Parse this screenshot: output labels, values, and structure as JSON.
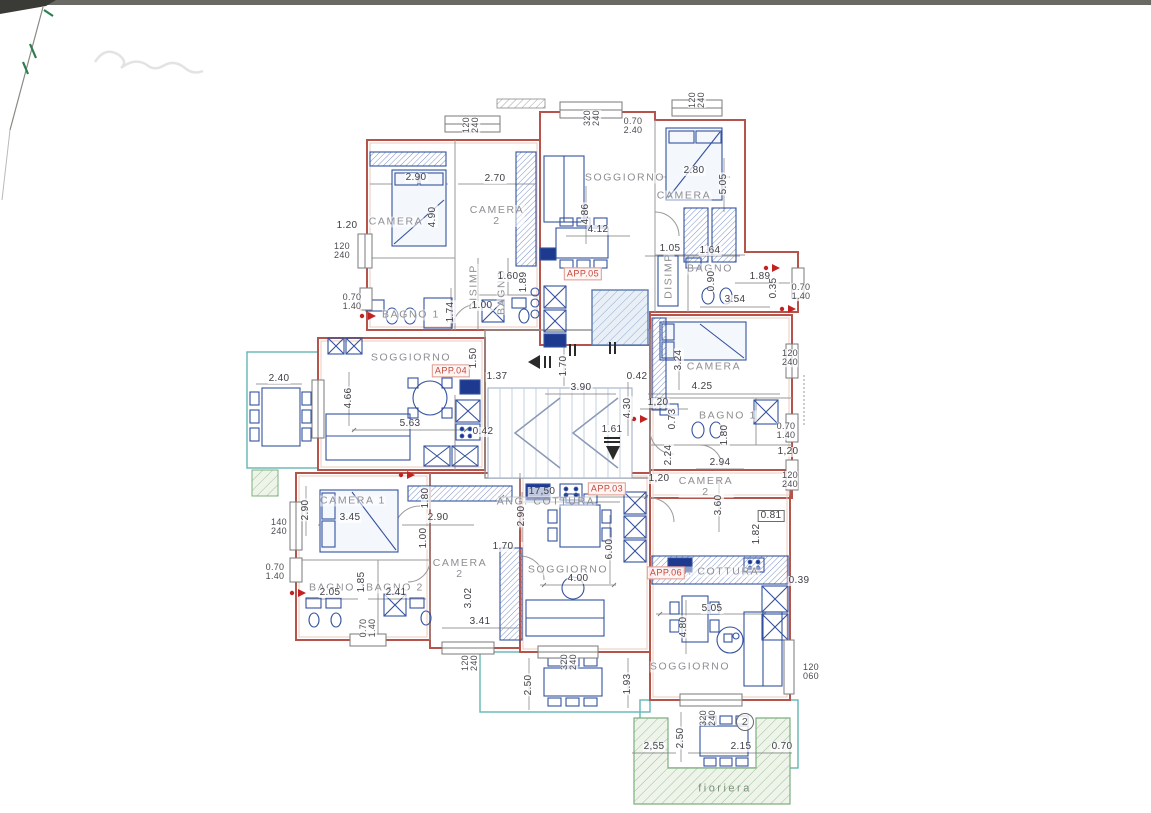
{
  "palette": {
    "wall_red": "#b5544b",
    "wall_pink": "#ecc8bf",
    "partition_gray": "#9a9a9a",
    "furniture_blue": "#33519e",
    "appliance_navy": "#1d3a8f",
    "terrace_teal": "#62b7b4",
    "planter_green": "#7fae7f",
    "elevator_blue": "#8fa9cd",
    "tag_red": "#c3463d",
    "dim_text": "#3e3e45",
    "room_text": "#8e8e93",
    "scan_mark_green": "#2e7d4f"
  },
  "plan": {
    "rooms": [
      {
        "t": "CAMERA",
        "x": 396,
        "y": 222
      },
      {
        "t": "CAMERA\n2",
        "x": 497,
        "y": 216
      },
      {
        "t": "SOGGIORNO",
        "x": 625,
        "y": 178
      },
      {
        "t": "CAMERA",
        "x": 684,
        "y": 196
      },
      {
        "t": "BAGNO",
        "x": 710,
        "y": 269
      },
      {
        "t": "DISIMP",
        "x": 474,
        "y": 287,
        "r": 1
      },
      {
        "t": "BAGNO",
        "x": 502,
        "y": 292,
        "r": 1
      },
      {
        "t": "DISIMP",
        "x": 669,
        "y": 276,
        "r": 1
      },
      {
        "t": "BAGNO 1",
        "x": 411,
        "y": 315
      },
      {
        "t": "SOGGIORNO",
        "x": 411,
        "y": 358
      },
      {
        "t": "CAMERA",
        "x": 714,
        "y": 367
      },
      {
        "t": "BAGNO 1",
        "x": 728,
        "y": 416
      },
      {
        "t": "CAMERA\n2",
        "x": 706,
        "y": 487
      },
      {
        "t": "CAMERA 1",
        "x": 353,
        "y": 501
      },
      {
        "t": "CAMERA\n2",
        "x": 460,
        "y": 569
      },
      {
        "t": "BAGNO 1",
        "x": 338,
        "y": 588
      },
      {
        "t": "BAGNO 2",
        "x": 395,
        "y": 588
      },
      {
        "t": "ANG. COTTURA",
        "x": 546,
        "y": 502
      },
      {
        "t": "SOGGIORNO",
        "x": 568,
        "y": 570
      },
      {
        "t": "ANG. COTTURA",
        "x": 710,
        "y": 572
      },
      {
        "t": "SOGGIORNO",
        "x": 690,
        "y": 667
      }
    ],
    "tags": [
      {
        "t": "APP.05",
        "x": 583,
        "y": 274
      },
      {
        "t": "APP.04",
        "x": 451,
        "y": 371
      },
      {
        "t": "APP.03",
        "x": 607,
        "y": 489
      },
      {
        "t": "APP.06",
        "x": 666,
        "y": 573
      }
    ],
    "windows": [
      {
        "t": "120\n240",
        "x": 471,
        "y": 125,
        "r": 1
      },
      {
        "t": "320\n240",
        "x": 592,
        "y": 118,
        "r": 1
      },
      {
        "t": "0.70\n2.40",
        "x": 633,
        "y": 126
      },
      {
        "t": "120\n240",
        "x": 697,
        "y": 100,
        "r": 1
      },
      {
        "t": "120\n240",
        "x": 342,
        "y": 251
      },
      {
        "t": "0.70\n1.40",
        "x": 352,
        "y": 302
      },
      {
        "t": "0.70\n1.40",
        "x": 801,
        "y": 292
      },
      {
        "t": "120\n240",
        "x": 790,
        "y": 358
      },
      {
        "t": "0.70\n1.40",
        "x": 786,
        "y": 431
      },
      {
        "t": "120\n240",
        "x": 790,
        "y": 480
      },
      {
        "t": "140\n240",
        "x": 279,
        "y": 527
      },
      {
        "t": "0.70\n1.40",
        "x": 275,
        "y": 572
      },
      {
        "t": "0.70\n1.40",
        "x": 368,
        "y": 628,
        "r": 1
      },
      {
        "t": "120\n240",
        "x": 470,
        "y": 663,
        "r": 1
      },
      {
        "t": "320\n240",
        "x": 569,
        "y": 662,
        "r": 1
      },
      {
        "t": "320\n240",
        "x": 708,
        "y": 718,
        "r": 1
      },
      {
        "t": "120\n060",
        "x": 811,
        "y": 672
      }
    ],
    "dims": [
      {
        "t": "2.90",
        "x": 416,
        "y": 178
      },
      {
        "t": "2.70",
        "x": 495,
        "y": 179
      },
      {
        "t": "1.20",
        "x": 347,
        "y": 226
      },
      {
        "t": "4.90",
        "x": 433,
        "y": 217,
        "r": 1
      },
      {
        "t": "1.74",
        "x": 451,
        "y": 312,
        "r": 1
      },
      {
        "t": "1.00",
        "x": 482,
        "y": 306
      },
      {
        "t": "1.60",
        "x": 508,
        "y": 277
      },
      {
        "t": "1.89",
        "x": 524,
        "y": 282,
        "r": 1
      },
      {
        "t": "4.86",
        "x": 586,
        "y": 214,
        "r": 1
      },
      {
        "t": "4.12",
        "x": 598,
        "y": 230
      },
      {
        "t": "2.80",
        "x": 694,
        "y": 171
      },
      {
        "t": "5.05",
        "x": 724,
        "y": 184,
        "r": 1
      },
      {
        "t": "1.05",
        "x": 670,
        "y": 249
      },
      {
        "t": "1.64",
        "x": 710,
        "y": 251
      },
      {
        "t": "0.90",
        "x": 712,
        "y": 281,
        "r": 1
      },
      {
        "t": "1.89",
        "x": 760,
        "y": 277
      },
      {
        "t": "0.35",
        "x": 774,
        "y": 288,
        "r": 1
      },
      {
        "t": "3.54",
        "x": 735,
        "y": 300
      },
      {
        "t": "2.40",
        "x": 279,
        "y": 379
      },
      {
        "t": "4.66",
        "x": 349,
        "y": 398,
        "r": 1
      },
      {
        "t": "5.63",
        "x": 410,
        "y": 424
      },
      {
        "t": "0.42",
        "x": 483,
        "y": 432
      },
      {
        "t": "1.50",
        "x": 474,
        "y": 358,
        "r": 1
      },
      {
        "t": "1.37",
        "x": 497,
        "y": 377
      },
      {
        "t": "1.70",
        "x": 564,
        "y": 366,
        "r": 1
      },
      {
        "t": "3.90",
        "x": 581,
        "y": 388
      },
      {
        "t": "0.42",
        "x": 637,
        "y": 377
      },
      {
        "t": "4.30",
        "x": 628,
        "y": 408,
        "r": 1
      },
      {
        "t": "1.61",
        "x": 612,
        "y": 430
      },
      {
        "t": "3.24",
        "x": 679,
        "y": 360,
        "r": 1
      },
      {
        "t": "4.25",
        "x": 702,
        "y": 387
      },
      {
        "t": "1,20",
        "x": 658,
        "y": 403
      },
      {
        "t": "0.73",
        "x": 673,
        "y": 419,
        "r": 1
      },
      {
        "t": "1.80",
        "x": 725,
        "y": 435,
        "r": 1
      },
      {
        "t": "1,20",
        "x": 788,
        "y": 452
      },
      {
        "t": "2.94",
        "x": 720,
        "y": 463
      },
      {
        "t": "2.24",
        "x": 669,
        "y": 455,
        "r": 1
      },
      {
        "t": "1,20",
        "x": 659,
        "y": 479
      },
      {
        "t": "3.60",
        "x": 719,
        "y": 505,
        "r": 1
      },
      {
        "t": "0.81",
        "x": 771,
        "y": 516,
        "box": 1
      },
      {
        "t": "1.82",
        "x": 757,
        "y": 534,
        "r": 1
      },
      {
        "t": "2.90",
        "x": 306,
        "y": 510,
        "r": 1
      },
      {
        "t": "3.45",
        "x": 350,
        "y": 518
      },
      {
        "t": "1.80",
        "x": 426,
        "y": 498,
        "r": 1
      },
      {
        "t": "2.90",
        "x": 438,
        "y": 518
      },
      {
        "t": "1.00",
        "x": 424,
        "y": 538,
        "r": 1
      },
      {
        "t": "1.70",
        "x": 503,
        "y": 547
      },
      {
        "t": "2.05",
        "x": 330,
        "y": 593
      },
      {
        "t": "1.85",
        "x": 362,
        "y": 582,
        "r": 1
      },
      {
        "t": "2.41",
        "x": 396,
        "y": 593
      },
      {
        "t": "3.02",
        "x": 469,
        "y": 598,
        "r": 1
      },
      {
        "t": "3.41",
        "x": 480,
        "y": 622
      },
      {
        "t": "17,50",
        "x": 542,
        "y": 492
      },
      {
        "t": "2.90",
        "x": 522,
        "y": 516,
        "r": 1
      },
      {
        "t": "6.00",
        "x": 610,
        "y": 549,
        "r": 1
      },
      {
        "t": "4.00",
        "x": 578,
        "y": 579
      },
      {
        "t": "2.50",
        "x": 529,
        "y": 685,
        "r": 1
      },
      {
        "t": "1.93",
        "x": 628,
        "y": 684,
        "r": 1
      },
      {
        "t": "0.39",
        "x": 799,
        "y": 581
      },
      {
        "t": "5.05",
        "x": 712,
        "y": 609
      },
      {
        "t": "4.80",
        "x": 684,
        "y": 627,
        "r": 1
      },
      {
        "t": "2.50",
        "x": 681,
        "y": 738,
        "r": 1
      },
      {
        "t": "2,55",
        "x": 654,
        "y": 747
      },
      {
        "t": "2.15",
        "x": 741,
        "y": 747
      },
      {
        "t": "0.70",
        "x": 782,
        "y": 747
      }
    ],
    "extras": [
      {
        "t": "fioriera",
        "x": 725,
        "y": 789,
        "cls": "fior"
      },
      {
        "t": "2",
        "x": 745,
        "y": 722,
        "circ": 1
      }
    ]
  }
}
